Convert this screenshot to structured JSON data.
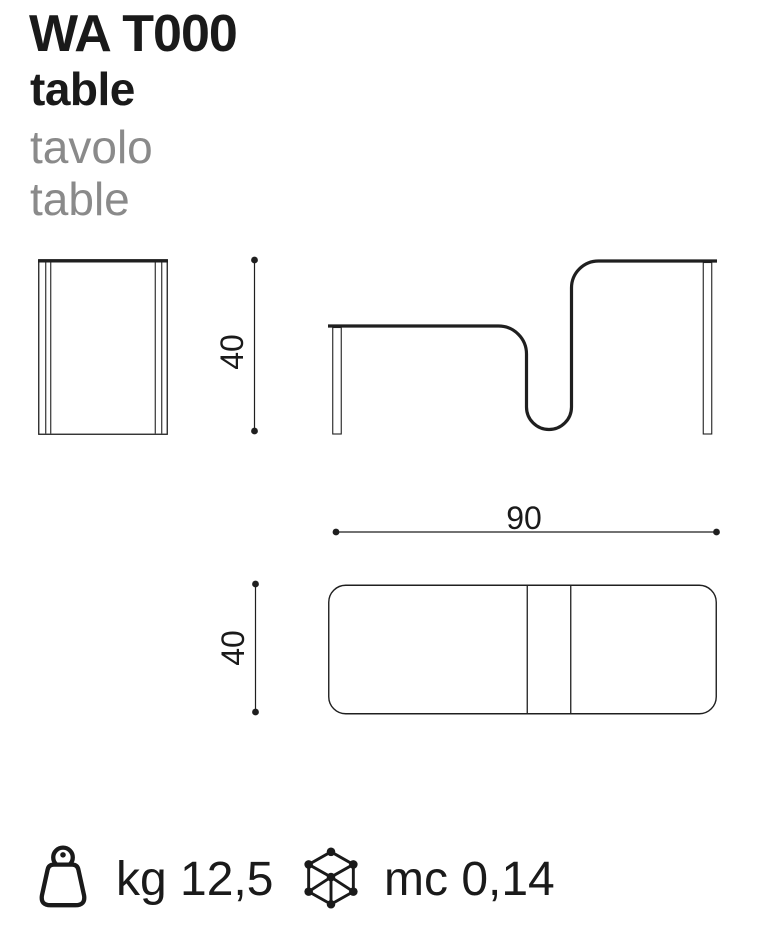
{
  "page": {
    "background": "#ffffff",
    "ink": "#1a1a1a",
    "muted_text": "#8a8a8a",
    "line_color": "#1f1f1f"
  },
  "header": {
    "model": "WA T000",
    "category": "table",
    "name_it": "tavolo",
    "name_en": "table"
  },
  "drawings": {
    "side_view": "side elevation of table",
    "front_view": "front elevation with wave-folded double top",
    "top_view": "plan view rounded rectangle",
    "front": {
      "height_dim": "40"
    },
    "top": {
      "width_dim": "90",
      "depth_dim": "40"
    }
  },
  "specs": {
    "weight": {
      "icon": "weight-icon",
      "value": "kg 12,5"
    },
    "volume": {
      "icon": "cube-icon",
      "value": "mc 0,14"
    }
  }
}
